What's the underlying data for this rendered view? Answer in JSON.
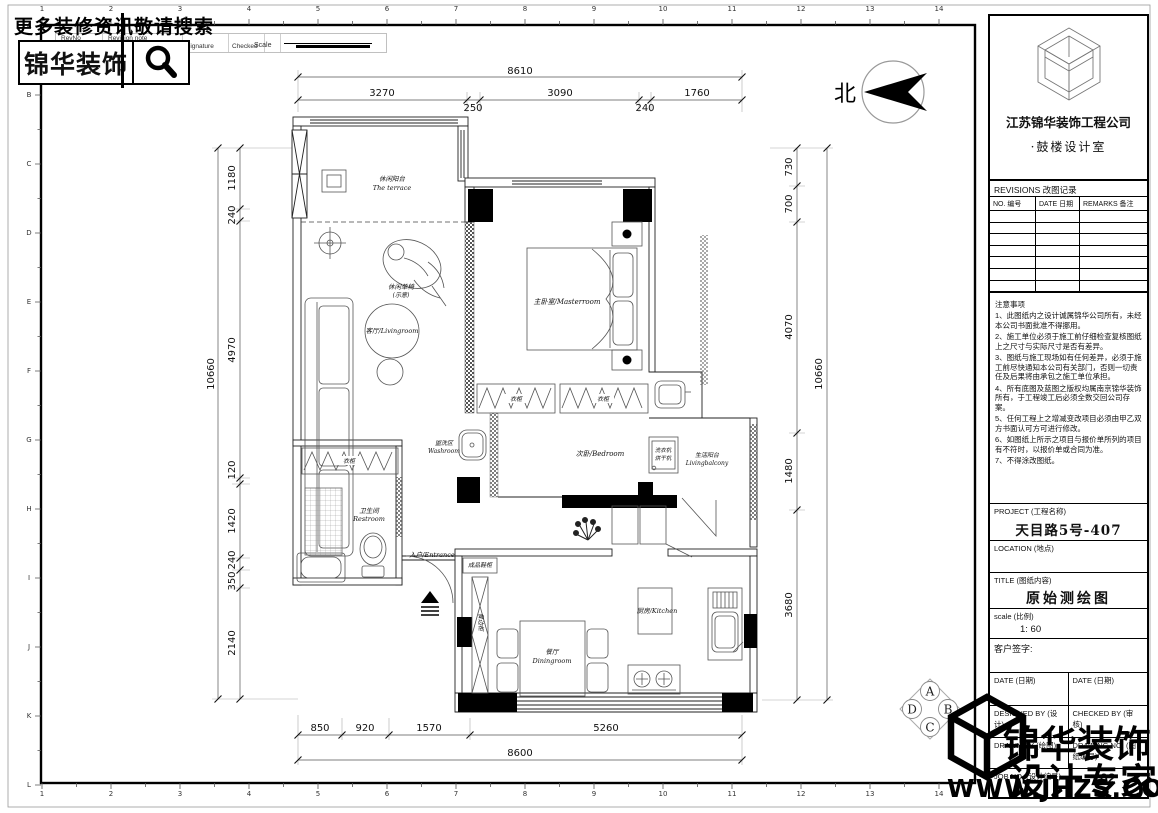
{
  "banner": {
    "text": "更多装修资讯敬请搜索"
  },
  "logo": {
    "text": "锦华装饰"
  },
  "strip": {
    "rev_no": "RevNo",
    "revision_note": "Revision note",
    "signature": "Signature",
    "checked": "Checked",
    "scale": "Scale"
  },
  "border": {
    "numbers": [
      "1",
      "2",
      "3",
      "4",
      "5",
      "6",
      "7",
      "8",
      "9",
      "10",
      "11",
      "12",
      "13",
      "14"
    ],
    "letters": [
      "A",
      "B",
      "C",
      "D",
      "E",
      "F",
      "G",
      "H",
      "I",
      "J",
      "K",
      "L"
    ]
  },
  "north": {
    "label": "北"
  },
  "plan": {
    "rooms": {
      "terrace_cn": "休闲阳台",
      "terrace_en": "The terrace",
      "lounge_chair_cn": "休闲单椅",
      "lounge_chair_note": "(示意)",
      "living": "客厅/Livingroom",
      "master": "主卧室/Masterroom",
      "wardrobe": "衣柜",
      "bedroom2": "次卧/Bedroom",
      "washer_1": "洗衣机",
      "washer_2": "烘干机",
      "balcony_cn": "生活阳台",
      "balcony_en": "Livingbalcony",
      "washroom_cn": "盥洗区",
      "washroom_en": "Washroom",
      "restroom_cn": "卫生间",
      "restroom_en": "Restroom",
      "entrance": "入户/Entrance",
      "shoe_cabinet": "成品鞋柜",
      "dining_cn": "餐厅",
      "dining_en": "Diningroom",
      "kitchen": "厨房/Kitchen",
      "sideboard": "餐边柜"
    },
    "dimensions": {
      "top_overall": "8610",
      "top_segments": [
        "3270",
        "250",
        "3090",
        "240",
        "1760"
      ],
      "bottom_segments": [
        "850",
        "920",
        "1570",
        "5260"
      ],
      "bottom_overall": "8600",
      "left_overall": "10660",
      "left_segments": [
        "1180",
        "240",
        "4970",
        "120",
        "1420",
        "240",
        "350",
        "2140"
      ],
      "right_segments": [
        "730",
        "700",
        "4070",
        "1480",
        "3680"
      ],
      "right_overall": "10660"
    },
    "ref_symbol": [
      "A",
      "B",
      "C",
      "D"
    ]
  },
  "title_block": {
    "company": "江苏锦华装饰工程公司",
    "department": "·鼓楼设计室",
    "revisions_title": "REVISIONS 改图记录",
    "rev_no": "NO. 编号",
    "rev_date": "DATE 日期",
    "rev_remarks": "REMARKS 备注",
    "notes_title": "注意事项",
    "notes": [
      "1、此图纸内之设计诚属锦华公司所有，未经本公司书面批准不得挪用。",
      "2、施工单位必须于施工前仔细检查复核图纸上之尺寸与实际尺寸是否有差异。",
      "3、图纸与施工现场如有任何差异，必须于施工前尽快通知本公司有关部门，否则一切责任及后果将由承包之施工单位承担。",
      "4、所有底图及蓝图之版权均属南京锦华装饰所有，于工程竣工后必须全数交回公司存案。",
      "5、任何工程上之增减变改项目必须由甲乙双方书面认可方可进行修改。",
      "6、如图纸上所示之项目与报价单所列的项目有不符时，以报价单或合同为准。",
      "7、不得涂改图纸。"
    ],
    "project_label": "PROJECT (工程名称)",
    "project_value": "天目路5号-407",
    "location_label": "LOCATION (地点)",
    "title_label": "TITLE (图纸内容)",
    "title_value": "原始测绘图",
    "scale_label": "scale (比例)",
    "scale_value": "1: 60",
    "sign_label": "客户签字:",
    "date_label_1": "DATE (日期)",
    "date_label_2": "DATE (日期)",
    "designed_by": "DESIGNED BY (设计)",
    "checked_by": "CHECKED BY (审核)",
    "drawn_by": "DRAWN BY (绘图)",
    "drawing_no_label": "DRAWING NO. (图纸编号)",
    "drawing_no_value": "02",
    "job_no_label": "JOB NO. (设计编号)"
  },
  "watermark": {
    "line1": "锦华装饰",
    "line2": "设计专家",
    "url": "WWW.JHZS.COM"
  }
}
